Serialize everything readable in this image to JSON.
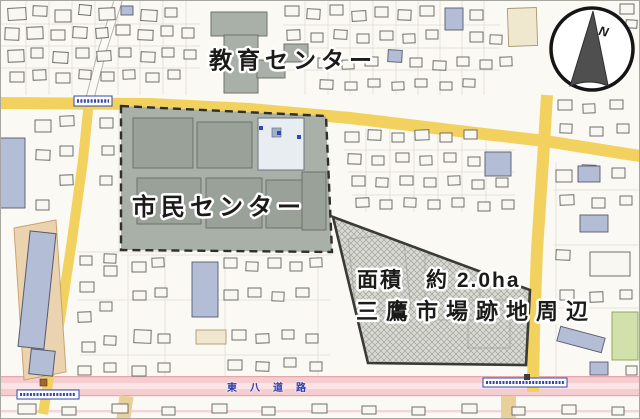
{
  "map": {
    "labels": {
      "education_center": "教育センター",
      "civic_center": "市民センター",
      "area": "面積　約 2.0ha",
      "site_name": "三鷹市場跡地周辺",
      "road_name": "東八道路"
    },
    "compass": {
      "north_label": "N"
    },
    "legend_colors": {
      "main_road_yellow": "#f2d15f",
      "tohachi_road_pink": "#f5cdd1",
      "public_block_gray": "#a9b0a7",
      "site_hatch_gray": "#dadad4",
      "building_blue": "#b4bdd6",
      "sign_text_blue": "#2b3fae"
    }
  }
}
